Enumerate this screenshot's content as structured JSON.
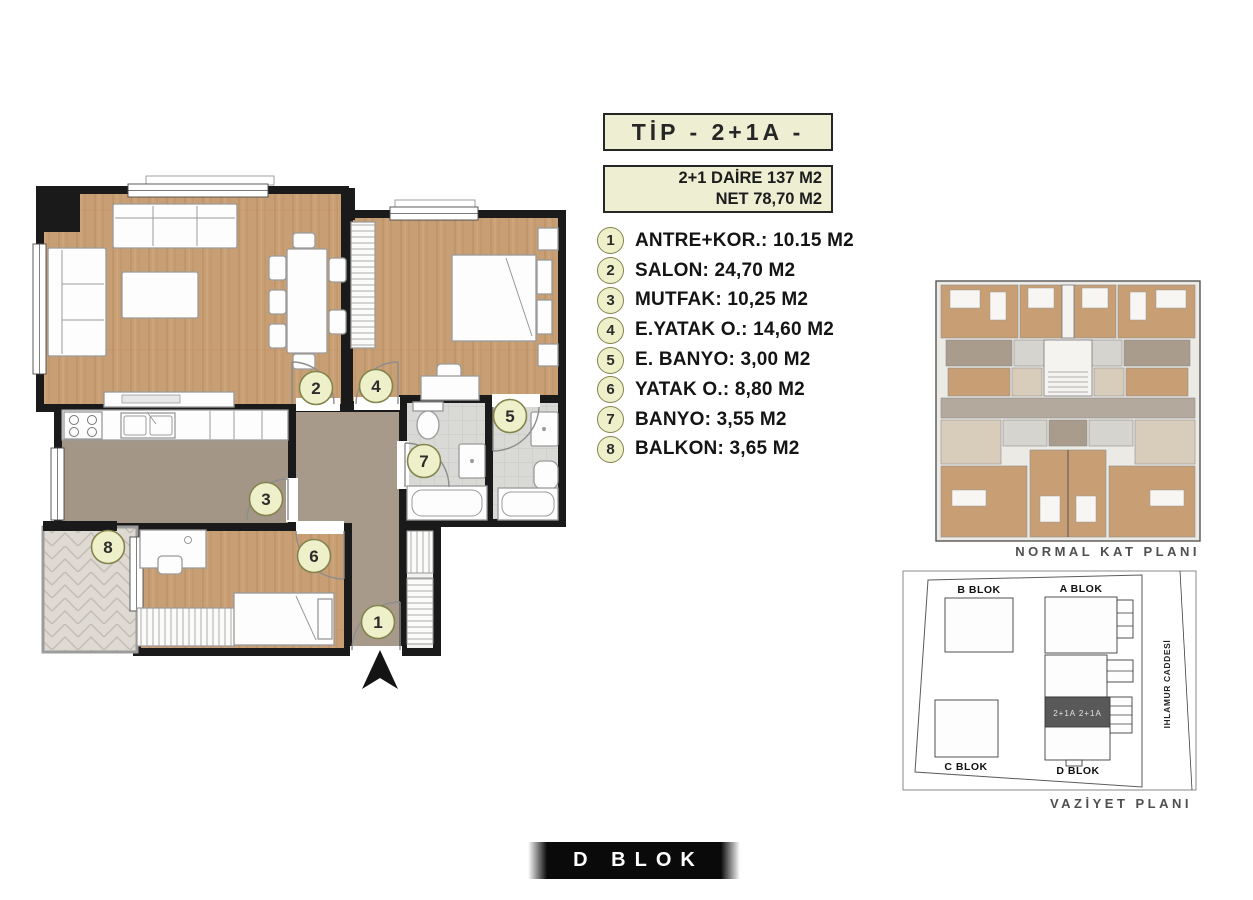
{
  "header": {
    "type_label": "TİP - 2+1A -",
    "area_line1": "2+1 DAİRE 137 M2",
    "area_line2": "NET 78,70 M2"
  },
  "legend": {
    "items": [
      {
        "num": "1",
        "label": "ANTRE+KOR.: 10.15 M2"
      },
      {
        "num": "2",
        "label": "SALON: 24,70 M2"
      },
      {
        "num": "3",
        "label": "MUTFAK: 10,25 M2"
      },
      {
        "num": "4",
        "label": "E.YATAK O.: 14,60 M2"
      },
      {
        "num": "5",
        "label": "E. BANYO: 3,00 M2"
      },
      {
        "num": "6",
        "label": "YATAK O.: 8,80 M2"
      },
      {
        "num": "7",
        "label": "BANYO: 3,55 M2"
      },
      {
        "num": "8",
        "label": "BALKON: 3,65 M2"
      }
    ]
  },
  "floor_plan": {
    "badges": [
      "1",
      "2",
      "3",
      "4",
      "5",
      "6",
      "7",
      "8"
    ]
  },
  "key_plan": {
    "caption": "NORMAL KAT PLANI"
  },
  "site_plan": {
    "caption": "VAZİYET PLANI",
    "street": "IHLAMUR CADDESİ",
    "block_a": "A BLOK",
    "block_b": "B BLOK",
    "block_c": "C BLOK",
    "block_d": "D BLOK",
    "highlight": "2+1A 2+1A"
  },
  "footer": {
    "block_label": "D BLOK"
  },
  "colors": {
    "wood_floor": "#c89e74",
    "hall_floor": "#a79a8b",
    "bath_tile": "#d9d9d6",
    "wall": "#1a1a1a",
    "badge_fill": "#eef0c9",
    "badge_border": "#83834d",
    "title_box_fill": "#eeeed3",
    "highlight_block": "#595959",
    "footer_band": "#0a0a0a"
  }
}
